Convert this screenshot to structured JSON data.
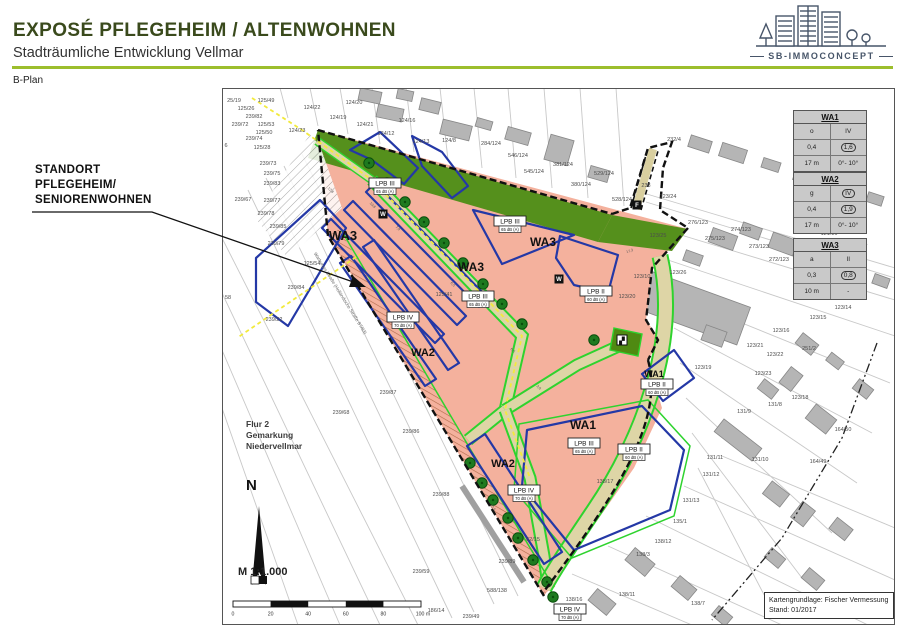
{
  "header": {
    "title": "EXPOSÉ PFLEGEHEIM / ALTENWOHNEN",
    "subtitle": "Stadträumliche Entwicklung Vellmar",
    "section_label": "B-Plan"
  },
  "logo": {
    "text": "SB-IMMOCONCEPT",
    "color": "#475569"
  },
  "annotation": {
    "lines": [
      "STANDORT",
      "PFLEGEHEIM/",
      "SENIORENWOHNEN"
    ]
  },
  "legend_tables": [
    {
      "title": "WA1",
      "rows": [
        [
          "o",
          "IV",
          false
        ],
        [
          "0,4",
          "1,6",
          true
        ],
        [
          "17 m",
          "0°- 10°",
          false
        ]
      ]
    },
    {
      "title": "WA2",
      "rows": [
        [
          "g",
          "IV",
          true
        ],
        [
          "0,4",
          "1,9",
          true
        ],
        [
          "17 m",
          "0°- 10°",
          false
        ]
      ]
    },
    {
      "title": "WA3",
      "rows": [
        [
          "a",
          "II",
          false
        ],
        [
          "0,3",
          "0,8",
          true
        ],
        [
          "10 m",
          "-",
          false
        ]
      ]
    }
  ],
  "map": {
    "area_labels": [
      {
        "t": "WA3",
        "x": 121,
        "y": 152,
        "s": 13
      },
      {
        "t": "WA3",
        "x": 249,
        "y": 183,
        "s": 12
      },
      {
        "t": "WA3",
        "x": 321,
        "y": 158,
        "s": 12
      },
      {
        "t": "WA2",
        "x": 201,
        "y": 268,
        "s": 11
      },
      {
        "t": "WA2",
        "x": 281,
        "y": 379,
        "s": 11
      },
      {
        "t": "WA1",
        "x": 361,
        "y": 341,
        "s": 12
      },
      {
        "t": "WA1",
        "x": 432,
        "y": 289,
        "s": 9
      }
    ],
    "noise_boxes": [
      {
        "t": "LPB III",
        "db": "65 dB (A)",
        "x": 163,
        "y": 100
      },
      {
        "t": "LPB III",
        "db": "65 dB (A)",
        "x": 288,
        "y": 138
      },
      {
        "t": "LPB III",
        "db": "65 dB (A)",
        "x": 256,
        "y": 213
      },
      {
        "t": "LPB IV",
        "db": "70 dB (A)",
        "x": 181,
        "y": 234
      },
      {
        "t": "LPB II",
        "db": "60 dB (A)",
        "x": 374,
        "y": 208
      },
      {
        "t": "LPB II",
        "db": "60 dB (A)",
        "x": 435,
        "y": 301
      },
      {
        "t": "LPB III",
        "db": "65 dB (A)",
        "x": 362,
        "y": 360
      },
      {
        "t": "LPB II",
        "db": "60 dB (A)",
        "x": 412,
        "y": 366
      },
      {
        "t": "LPB IV",
        "db": "70 dB (A)",
        "x": 302,
        "y": 407
      },
      {
        "t": "LPB IV",
        "db": "70 dB (A)",
        "x": 348,
        "y": 526
      }
    ],
    "poi_icons": [
      {
        "g": "W",
        "x": 161,
        "y": 126,
        "name": "turning-area-icon"
      },
      {
        "g": "W",
        "x": 337,
        "y": 191,
        "name": "turning-area-icon"
      },
      {
        "g": "F",
        "x": 415,
        "y": 117,
        "name": "footpath-marker-icon"
      },
      {
        "g": "▞",
        "x": 400,
        "y": 252,
        "name": "playground-icon"
      }
    ],
    "parcels": [
      {
        "t": "25/19",
        "x": 12,
        "y": 14
      },
      {
        "t": "125/49",
        "x": 44,
        "y": 14
      },
      {
        "t": "125/26",
        "x": 24,
        "y": 22
      },
      {
        "t": "239/82",
        "x": 32,
        "y": 30
      },
      {
        "t": "239/72",
        "x": 18,
        "y": 38
      },
      {
        "t": "125/53",
        "x": 44,
        "y": 38
      },
      {
        "t": "125/50",
        "x": 42,
        "y": 46
      },
      {
        "t": "239/74",
        "x": 32,
        "y": 52
      },
      {
        "t": "125/28",
        "x": 40,
        "y": 61
      },
      {
        "t": "239/73",
        "x": 46,
        "y": 77
      },
      {
        "t": "239/75",
        "x": 50,
        "y": 87
      },
      {
        "t": "239/83",
        "x": 50,
        "y": 97
      },
      {
        "t": "239/67",
        "x": 21,
        "y": 113
      },
      {
        "t": "239/77",
        "x": 50,
        "y": 114
      },
      {
        "t": "239/78",
        "x": 44,
        "y": 127
      },
      {
        "t": "239/85",
        "x": 56,
        "y": 140
      },
      {
        "t": "239/79",
        "x": 54,
        "y": 157
      },
      {
        "t": "125/54",
        "x": 90,
        "y": 177
      },
      {
        "t": "239/84",
        "x": 74,
        "y": 201
      },
      {
        "t": "239/22",
        "x": 52,
        "y": 233
      },
      {
        "t": "58",
        "x": 6,
        "y": 211
      },
      {
        "t": "6",
        "x": 4,
        "y": 59
      },
      {
        "t": "124/22",
        "x": 90,
        "y": 21
      },
      {
        "t": "124/20",
        "x": 132,
        "y": 16
      },
      {
        "t": "124/19",
        "x": 116,
        "y": 31
      },
      {
        "t": "124/21",
        "x": 143,
        "y": 38
      },
      {
        "t": "124/16",
        "x": 185,
        "y": 34
      },
      {
        "t": "124/12",
        "x": 164,
        "y": 47
      },
      {
        "t": "124/13",
        "x": 199,
        "y": 55
      },
      {
        "t": "124/8",
        "x": 227,
        "y": 54
      },
      {
        "t": "124/23",
        "x": 75,
        "y": 44
      },
      {
        "t": "284/124",
        "x": 269,
        "y": 57
      },
      {
        "t": "546/124",
        "x": 296,
        "y": 69
      },
      {
        "t": "381/124",
        "x": 341,
        "y": 78
      },
      {
        "t": "545/124",
        "x": 312,
        "y": 85
      },
      {
        "t": "529/124",
        "x": 382,
        "y": 87
      },
      {
        "t": "380/124",
        "x": 359,
        "y": 98
      },
      {
        "t": "528/124",
        "x": 400,
        "y": 113
      },
      {
        "t": "232/4",
        "x": 452,
        "y": 53
      },
      {
        "t": "238",
        "x": 424,
        "y": 99
      },
      {
        "t": "123/24",
        "x": 446,
        "y": 110
      },
      {
        "t": "276/123",
        "x": 476,
        "y": 136
      },
      {
        "t": "275/123",
        "x": 493,
        "y": 152
      },
      {
        "t": "274/123",
        "x": 519,
        "y": 143
      },
      {
        "t": "273/123",
        "x": 537,
        "y": 160
      },
      {
        "t": "272/123",
        "x": 557,
        "y": 173
      },
      {
        "t": "123/25",
        "x": 436,
        "y": 149
      },
      {
        "t": "123/26",
        "x": 456,
        "y": 186
      },
      {
        "t": "123/10",
        "x": 420,
        "y": 190
      },
      {
        "t": "123/20",
        "x": 405,
        "y": 210
      },
      {
        "t": "123/19",
        "x": 481,
        "y": 281
      },
      {
        "t": "123/14",
        "x": 621,
        "y": 221
      },
      {
        "t": "123/15",
        "x": 596,
        "y": 231
      },
      {
        "t": "123/16",
        "x": 559,
        "y": 244
      },
      {
        "t": "123/21",
        "x": 533,
        "y": 259
      },
      {
        "t": "123/22",
        "x": 553,
        "y": 268
      },
      {
        "t": "251/2",
        "x": 587,
        "y": 262
      },
      {
        "t": "123/23",
        "x": 541,
        "y": 287
      },
      {
        "t": "123/18",
        "x": 578,
        "y": 311
      },
      {
        "t": "131/8",
        "x": 553,
        "y": 318
      },
      {
        "t": "131/9",
        "x": 522,
        "y": 325
      },
      {
        "t": "131/11",
        "x": 493,
        "y": 371
      },
      {
        "t": "131/10",
        "x": 538,
        "y": 373
      },
      {
        "t": "131/12",
        "x": 489,
        "y": 388
      },
      {
        "t": "164/50",
        "x": 621,
        "y": 343
      },
      {
        "t": "164/49",
        "x": 596,
        "y": 375
      },
      {
        "t": "131/13",
        "x": 469,
        "y": 414
      },
      {
        "t": "135/1",
        "x": 458,
        "y": 435
      },
      {
        "t": "138/12",
        "x": 441,
        "y": 455
      },
      {
        "t": "138/3",
        "x": 421,
        "y": 468
      },
      {
        "t": "138/11",
        "x": 405,
        "y": 508
      },
      {
        "t": "138/7",
        "x": 476,
        "y": 517
      },
      {
        "t": "121/16",
        "x": 607,
        "y": 147
      },
      {
        "t": "121/14",
        "x": 637,
        "y": 158
      },
      {
        "t": "239/87",
        "x": 166,
        "y": 306
      },
      {
        "t": "239/68",
        "x": 119,
        "y": 326
      },
      {
        "t": "239/86",
        "x": 189,
        "y": 345
      },
      {
        "t": "239/88",
        "x": 219,
        "y": 408
      },
      {
        "t": "239/59",
        "x": 199,
        "y": 485
      },
      {
        "t": "239/89",
        "x": 285,
        "y": 475
      },
      {
        "t": "588/138",
        "x": 275,
        "y": 504
      },
      {
        "t": "186/14",
        "x": 214,
        "y": 524
      },
      {
        "t": "239/49",
        "x": 249,
        "y": 530
      },
      {
        "t": "138/16",
        "x": 352,
        "y": 513
      },
      {
        "t": "62/15",
        "x": 311,
        "y": 453
      },
      {
        "t": "125/41",
        "x": 222,
        "y": 208
      },
      {
        "t": "138/17",
        "x": 383,
        "y": 395
      }
    ],
    "dims": [
      {
        "t": "12,8",
        "x": 108,
        "y": 103,
        "r": 45
      },
      {
        "t": "10,8",
        "x": 150,
        "y": 118,
        "r": 45
      },
      {
        "t": "7,9",
        "x": 175,
        "y": 141,
        "r": 45
      },
      {
        "t": "6,5",
        "x": 230,
        "y": 197,
        "r": 45
      },
      {
        "t": "17,3",
        "x": 408,
        "y": 164,
        "r": -18
      },
      {
        "t": "6,5",
        "x": 290,
        "y": 263,
        "r": 45
      },
      {
        "t": "12,5",
        "x": 270,
        "y": 420,
        "r": 56
      },
      {
        "t": "3,0",
        "x": 316,
        "y": 300,
        "r": 45
      }
    ],
    "street_label": {
      "t": "Warburger Straße (Holländische Straße B7/83)",
      "x": 117,
      "y": 206,
      "r": 58
    },
    "flur_lines": [
      "Flur 2",
      "Gemarkung",
      "Niedervellmar"
    ],
    "north_label": "N",
    "scale_label": "M 1:1.000",
    "scale_ticks": [
      "0",
      "20",
      "40",
      "60",
      "80",
      "100 m"
    ],
    "credit": [
      "Kartengrundlage: Fischer Vermessung",
      "Stand: 01/2017"
    ]
  },
  "colors": {
    "accent_green": "#9cbe2d",
    "title_green": "#3a4a1c",
    "logo_navy": "#475569",
    "plan_salmon": "#f4b19d",
    "green_area": "#55901c",
    "road_beige": "#ded5a6",
    "road_edge_green": "#2ed32e",
    "envelope_blue": "#2438a6",
    "tree_green": "#1e7a1f",
    "lighting_yellow": "#f2ea3d",
    "table_grey": "#c9c9c9"
  }
}
